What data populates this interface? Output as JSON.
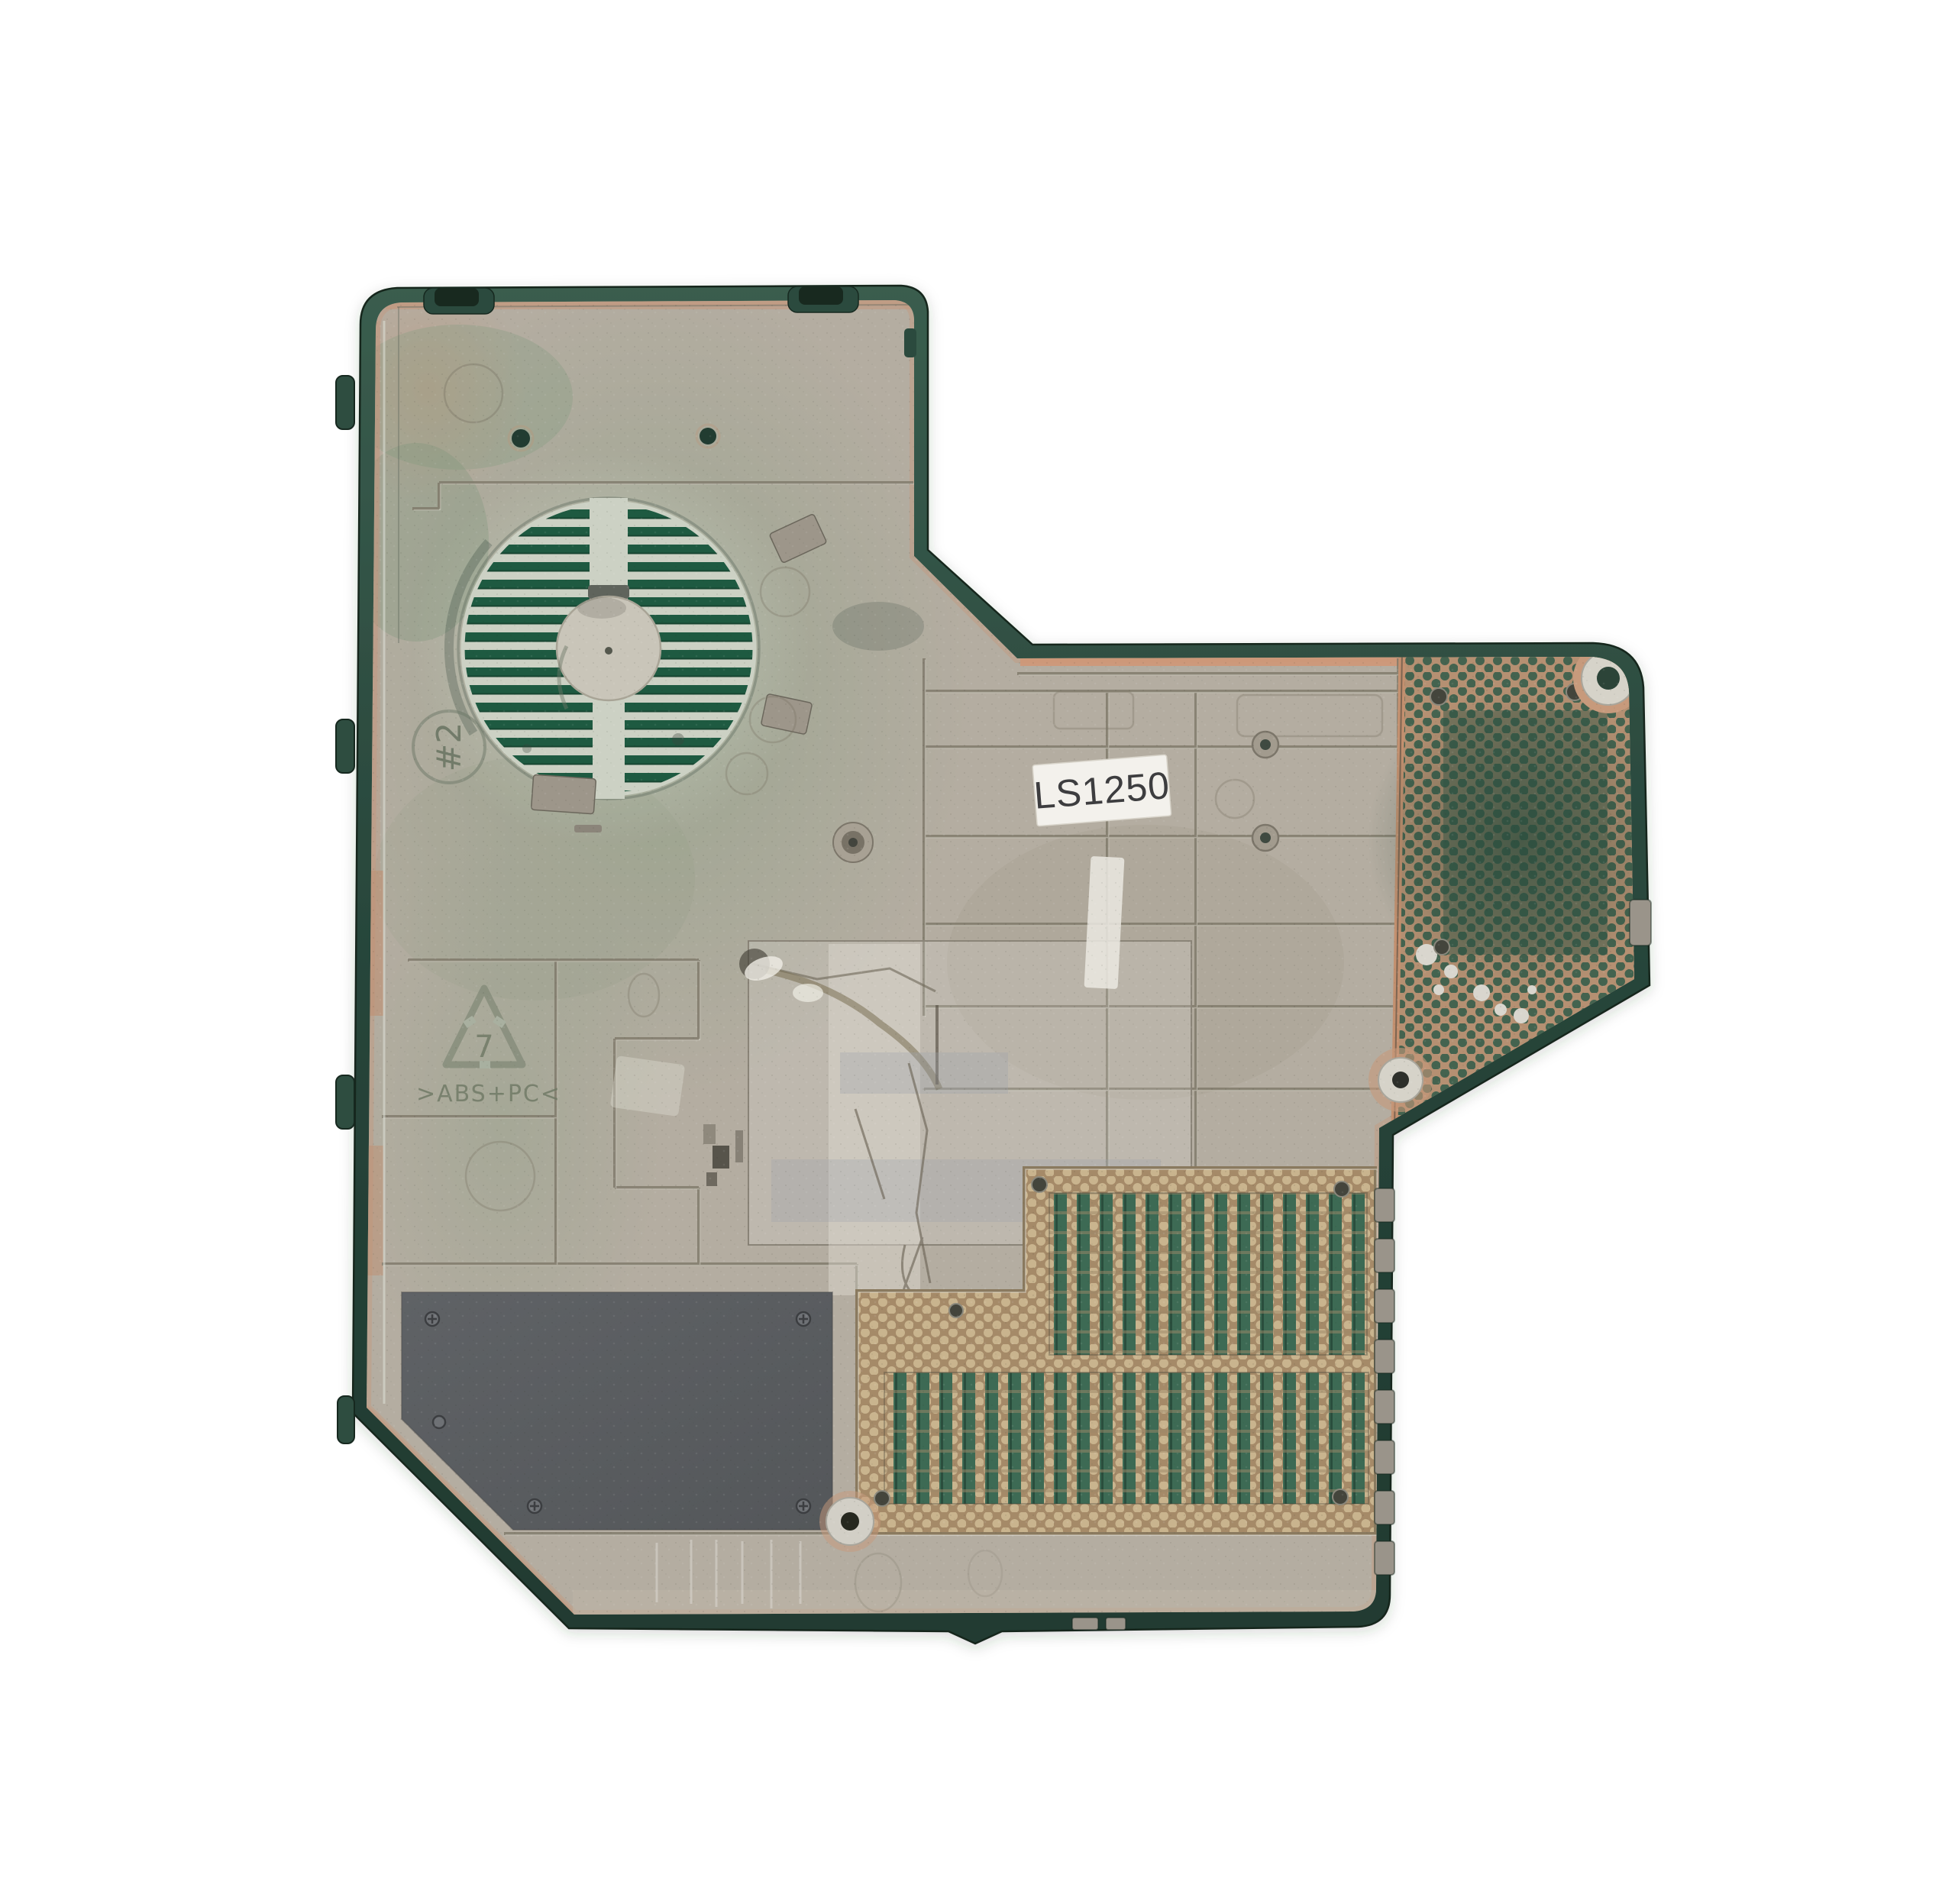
{
  "part": {
    "label": {
      "text": "LS1250"
    },
    "markings": {
      "mold_circle_text": "#2",
      "recycle_number": "7",
      "material_code": ">ABS+PC<"
    }
  },
  "colors": {
    "background": "#ffffff",
    "rim_green": "#2c4c40",
    "rim_green_dark": "#1c332a",
    "surface_gray": "#b4ada1",
    "copper": "#c6957a",
    "copper_strong": "#cf9777",
    "fan_slot_green": "#1e5a41",
    "fan_gap_pale": "#ccd1c4",
    "mesh_bronze_top": "#b59072",
    "mesh_hole_green": "#44634f",
    "mesh_bronze_bottom": "#a58a68",
    "mesh_hole_tan": "#c9b48e",
    "slat_green": "#3d6a54",
    "pad_gray": "#595c5f",
    "label_bg": "#f3f1ec",
    "label_text": "#3d3d3f",
    "marking_green": "#6f7965",
    "rib_gray": "#7d7768",
    "silver": "#d6d3c9"
  }
}
